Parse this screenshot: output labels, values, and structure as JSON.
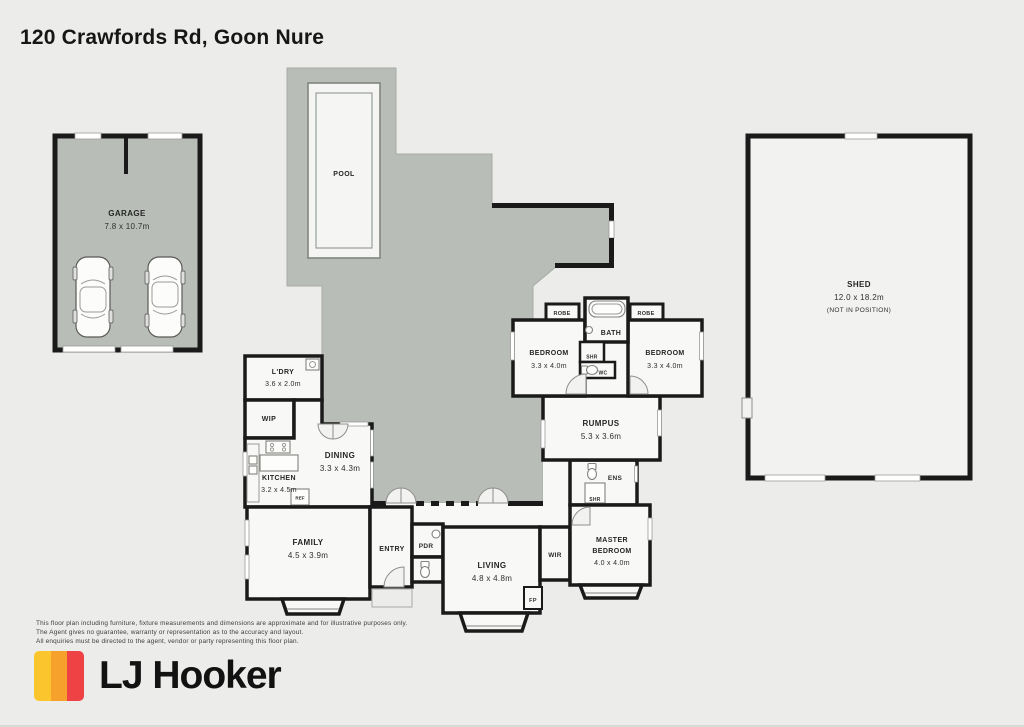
{
  "title": "120 Crawfords Rd, Goon Nure",
  "outbuildings": {
    "garage": {
      "name": "GARAGE",
      "dims": "7.8 x 10.7m"
    },
    "pool": {
      "name": "POOL"
    },
    "shed": {
      "name": "SHED",
      "dims": "12.0 x 18.2m",
      "note": "(NOT IN POSITION)"
    }
  },
  "rooms": {
    "ldry": {
      "name": "L'DRY",
      "dims": "3.6 x 2.0m"
    },
    "wip": {
      "name": "WIP"
    },
    "kitchen": {
      "name": "KITCHEN",
      "dims": "3.2 x 4.5m"
    },
    "dining": {
      "name": "DINING",
      "dims": "3.3 x 4.3m"
    },
    "family": {
      "name": "FAMILY",
      "dims": "4.5 x 3.9m"
    },
    "entry": {
      "name": "ENTRY"
    },
    "pdr": {
      "name": "PDR"
    },
    "living": {
      "name": "LIVING",
      "dims": "4.8 x 4.8m"
    },
    "wir": {
      "name": "WIR"
    },
    "master": {
      "name_line1": "MASTER",
      "name_line2": "BEDROOM",
      "dims": "4.0 x 4.0m"
    },
    "ens": {
      "name": "ENS"
    },
    "shr_ens": {
      "name": "SHR"
    },
    "rumpus": {
      "name": "RUMPUS",
      "dims": "5.3 x 3.6m"
    },
    "bedroom1": {
      "name": "BEDROOM",
      "dims": "3.3 x 4.0m"
    },
    "bedroom2": {
      "name": "BEDROOM",
      "dims": "3.3 x 4.0m"
    },
    "robe1": {
      "name": "ROBE"
    },
    "robe2": {
      "name": "ROBE"
    },
    "bath": {
      "name": "BATH"
    },
    "shr_bath": {
      "name": "SHR"
    },
    "wc": {
      "name": "WC"
    },
    "ref": {
      "name": "REF"
    },
    "fp": {
      "name": "FP"
    }
  },
  "footer": {
    "disclaimer": [
      "This floor plan including furniture, fixture measurements and dimensions are approximate and for illustrative purposes only.",
      "The Agent gives no guarantee, warranty or representation as to the accuracy and layout.",
      "All enquiries must be directed to the agent, vendor or party representing this floor plan."
    ],
    "brand": "LJ Hooker"
  },
  "colors": {
    "background": "#ECECEA",
    "area_fill": "#B8BDB7",
    "wall": "#1A1A1A",
    "room_fill": "#F8F8F6",
    "shed_fill": "#F2F2F0",
    "logo_yellow": "#FBC62D",
    "logo_orange": "#F5A12B",
    "logo_red": "#EE4245",
    "text": "#222222"
  }
}
